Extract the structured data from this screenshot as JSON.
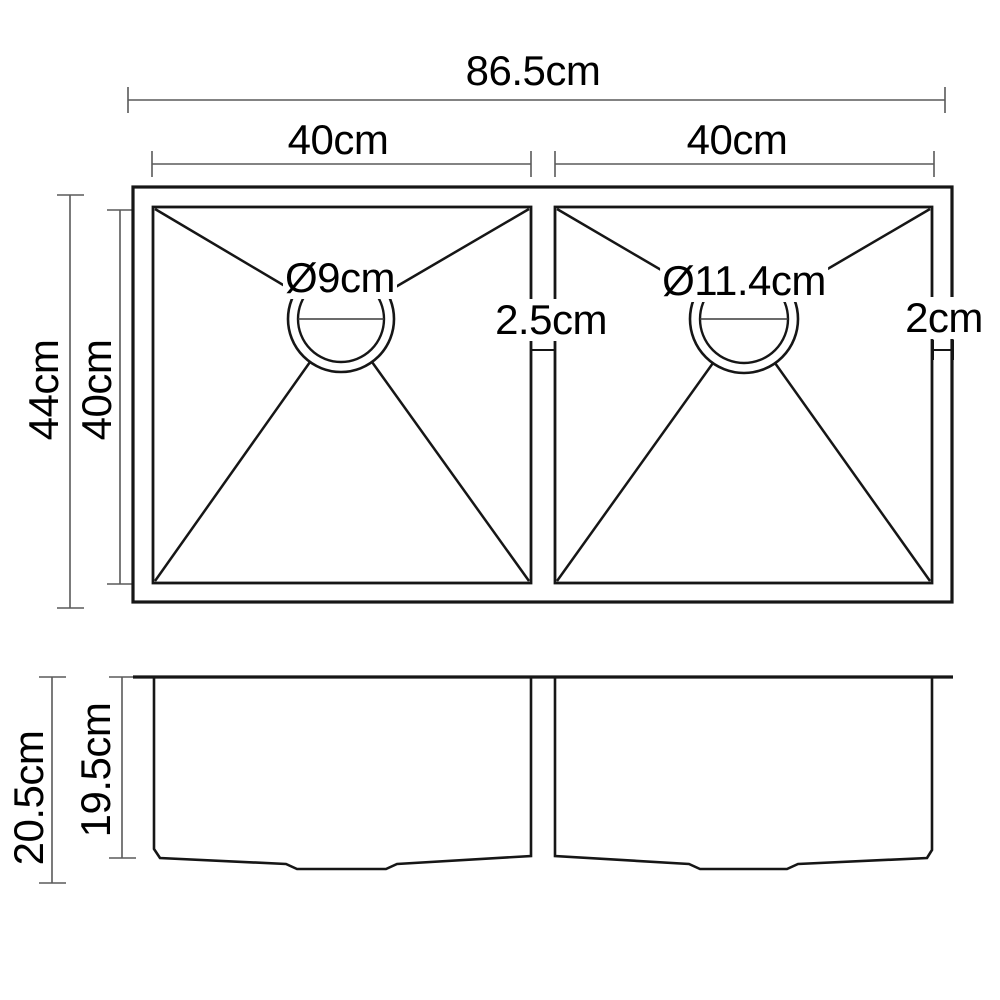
{
  "diagram": {
    "top_view": {
      "overall_width": "86.5cm",
      "left_bowl_width": "40cm",
      "right_bowl_width": "40cm",
      "overall_depth": "44cm",
      "bowl_inner_depth": "40cm",
      "left_drain_diameter": "Ø9cm",
      "right_drain_diameter": "Ø11.4cm",
      "center_divider_width": "2.5cm",
      "right_edge_width": "2cm"
    },
    "side_view": {
      "overall_height": "20.5cm",
      "bowl_inner_height": "19.5cm"
    },
    "colors": {
      "background": "#ffffff",
      "outline": "#161616",
      "dimension_line": "#5a5a5a",
      "text": "#000000"
    }
  }
}
